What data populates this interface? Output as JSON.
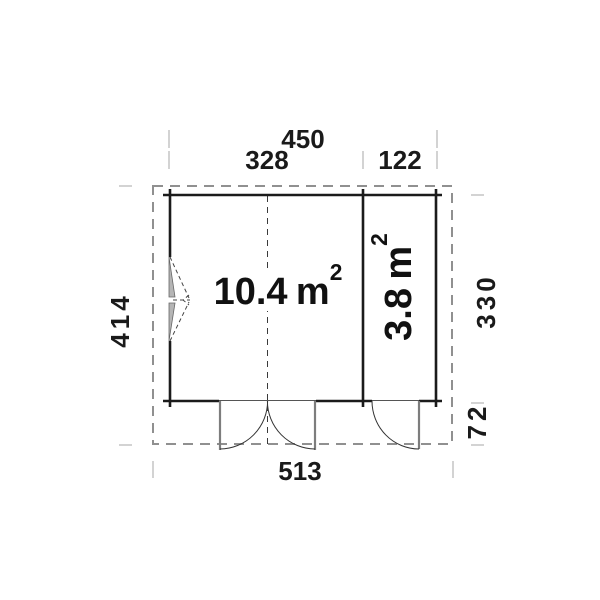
{
  "diagram": {
    "type": "floor-plan",
    "dimensions": {
      "width_total": "450",
      "width_room_main": "328",
      "width_room_side": "122",
      "depth_total": "414",
      "depth_interior": "330",
      "porch_depth": "72",
      "width_overall": "513"
    },
    "rooms": [
      {
        "name": "main-room",
        "area_value": "10.4",
        "area_unit": "m",
        "area_sup": "2"
      },
      {
        "name": "side-room",
        "area_value": "3.8",
        "area_unit": "m",
        "area_sup": "2"
      }
    ],
    "colors": {
      "wall": "#1b1b1b",
      "roof_outline": "#909090",
      "tick": "#c8c8c8",
      "door": "#7d7d7d",
      "window_fill": "#b5b5b5",
      "text": "#1a1a1a",
      "background": "#ffffff"
    }
  }
}
